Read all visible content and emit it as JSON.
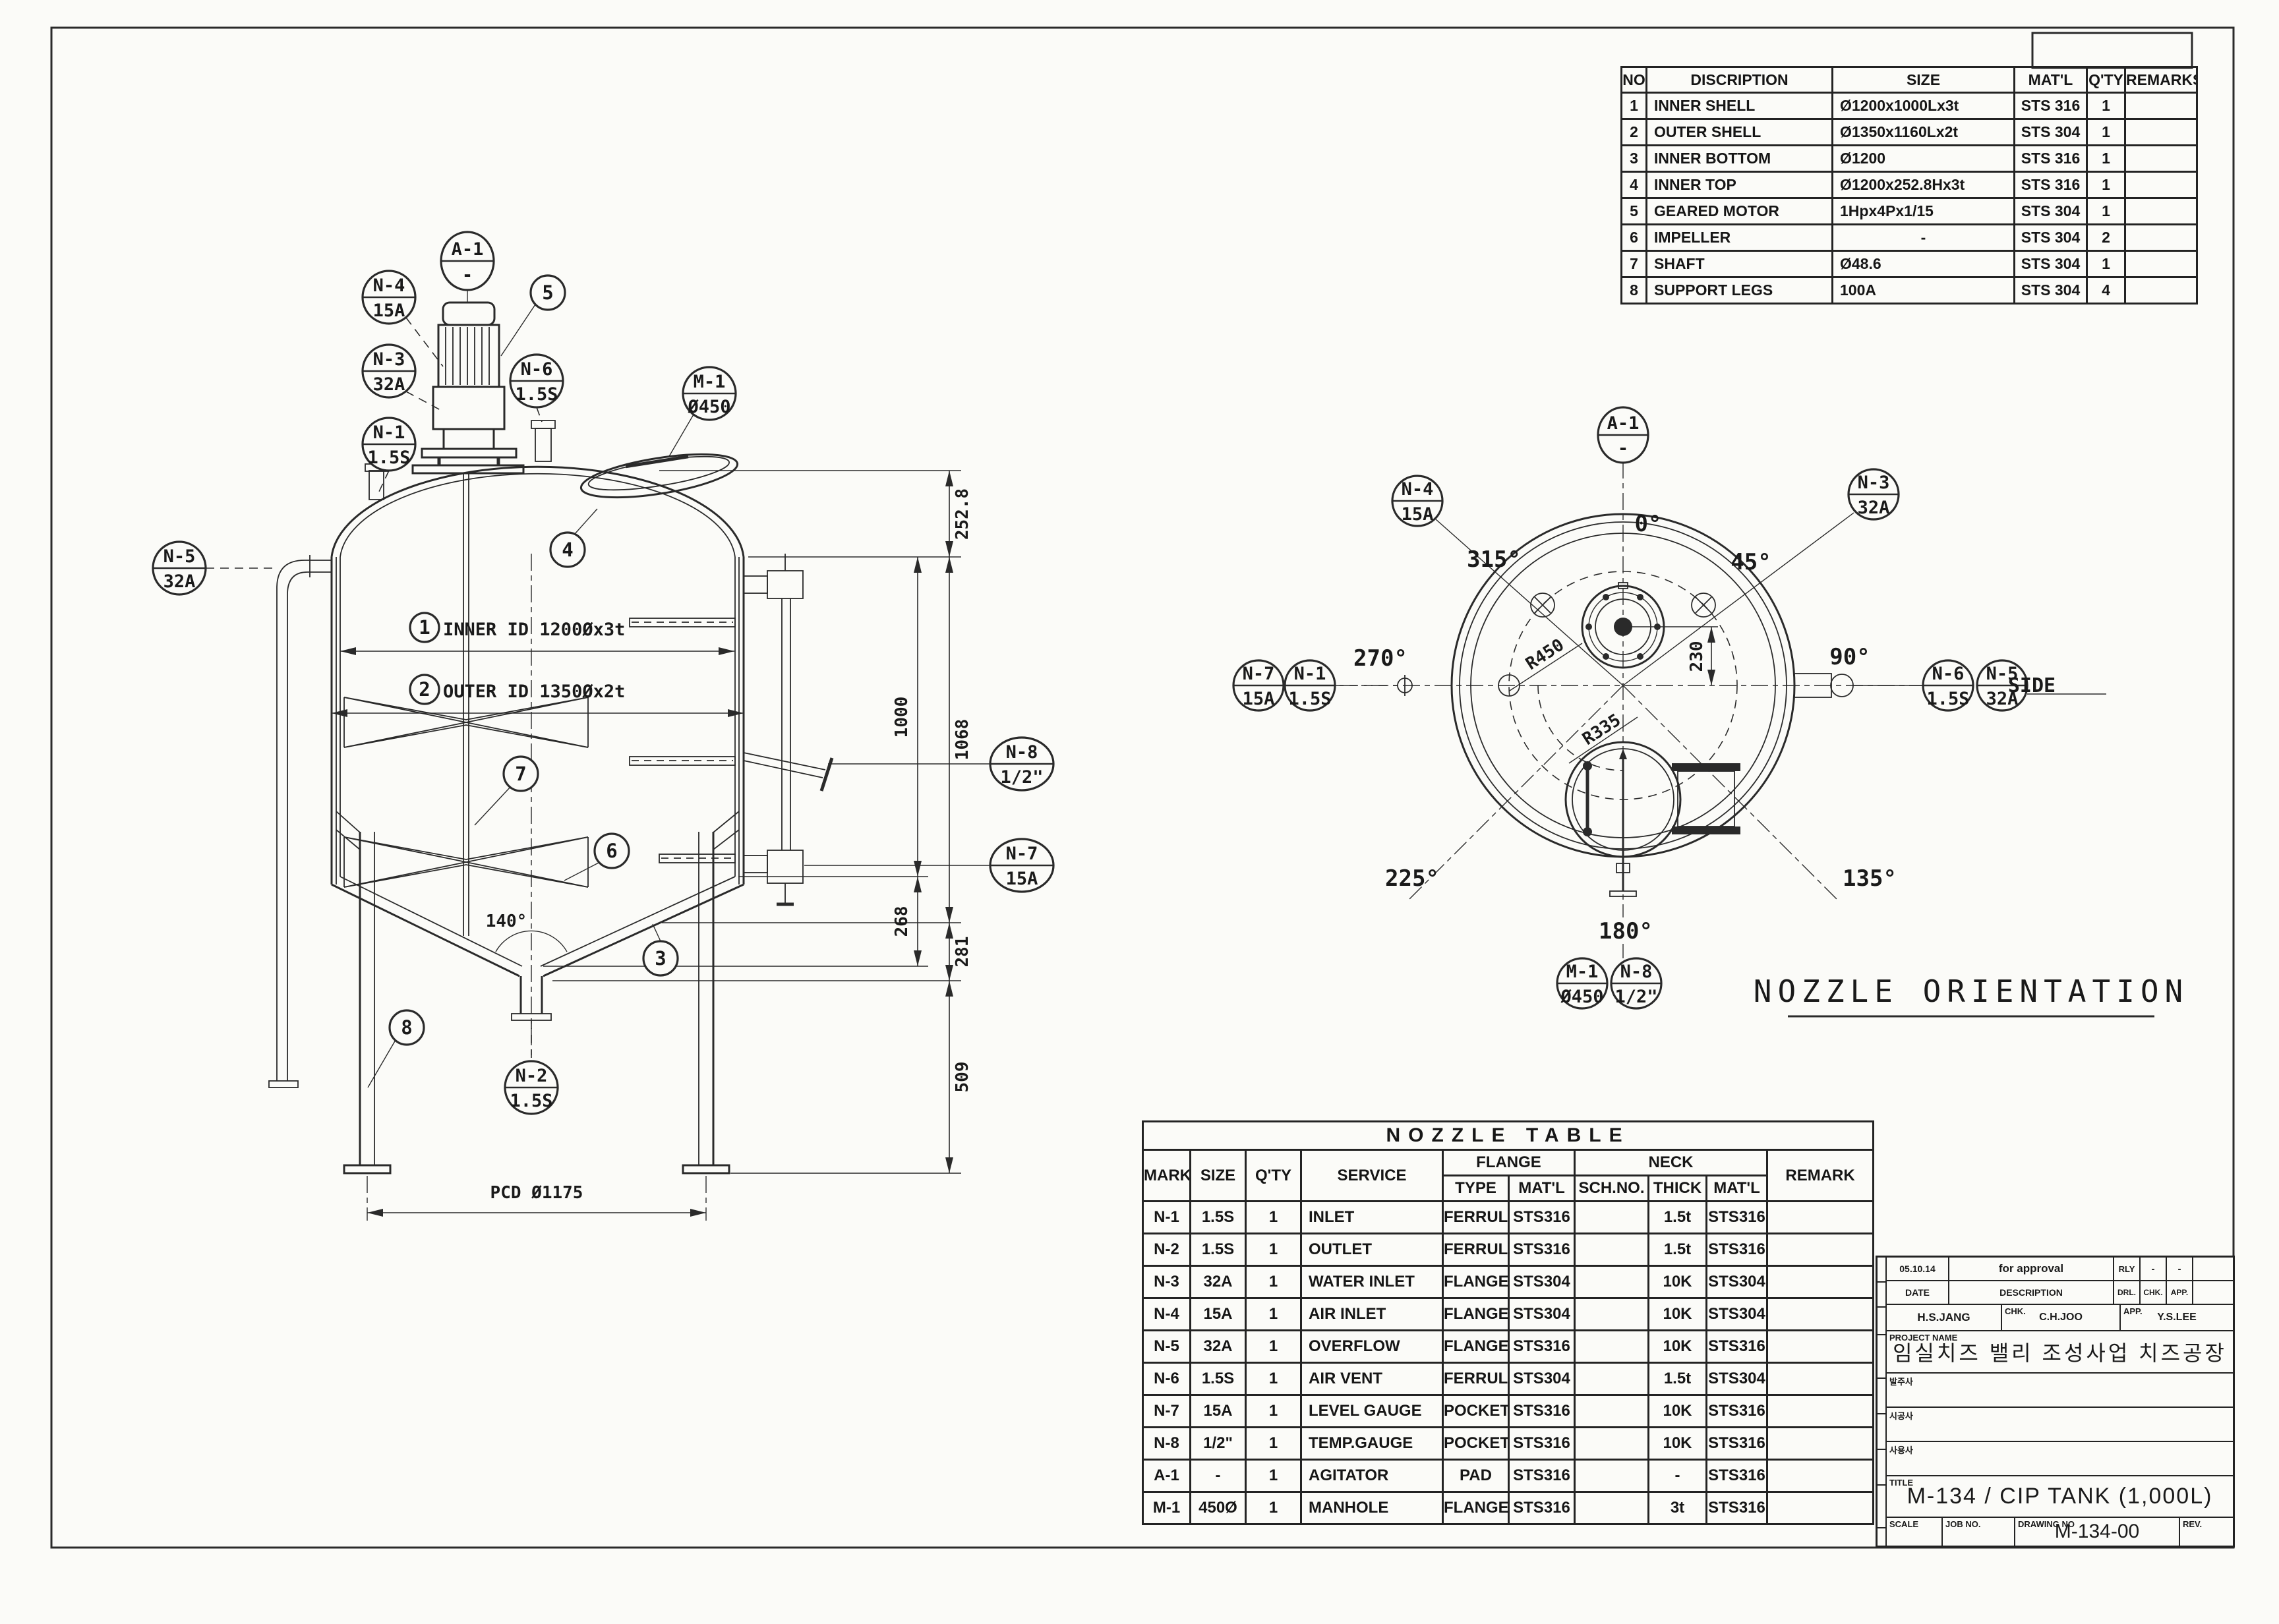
{
  "colors": {
    "ink": "#2a2a2a",
    "paper": "#fbfbf8"
  },
  "parts_table": {
    "headers": {
      "no": "NO",
      "desc": "DISCRIPTION",
      "size": "SIZE",
      "matl": "MAT'L",
      "qty": "Q'TY",
      "remarks": "REMARKS"
    },
    "rows": [
      {
        "no": "1",
        "desc": "INNER SHELL",
        "size": "Ø1200x1000Lx3t",
        "matl": "STS 316",
        "qty": "1",
        "remarks": ""
      },
      {
        "no": "2",
        "desc": "OUTER SHELL",
        "size": "Ø1350x1160Lx2t",
        "matl": "STS 304",
        "qty": "1",
        "remarks": ""
      },
      {
        "no": "3",
        "desc": "INNER BOTTOM",
        "size": "Ø1200",
        "matl": "STS 316",
        "qty": "1",
        "remarks": ""
      },
      {
        "no": "4",
        "desc": "INNER TOP",
        "size": "Ø1200x252.8Hx3t",
        "matl": "STS 316",
        "qty": "1",
        "remarks": ""
      },
      {
        "no": "5",
        "desc": "GEARED MOTOR",
        "size": "1Hpx4Px1/15",
        "matl": "STS 304",
        "qty": "1",
        "remarks": ""
      },
      {
        "no": "6",
        "desc": "IMPELLER",
        "size": "-",
        "matl": "STS 304",
        "qty": "2",
        "remarks": ""
      },
      {
        "no": "7",
        "desc": "SHAFT",
        "size": "Ø48.6",
        "matl": "STS 304",
        "qty": "1",
        "remarks": ""
      },
      {
        "no": "8",
        "desc": "SUPPORT LEGS",
        "size": "100A",
        "matl": "STS 304",
        "qty": "4",
        "remarks": ""
      }
    ]
  },
  "nozzle_table": {
    "title": "NOZZLE TABLE",
    "headers": {
      "mark": "MARK",
      "size": "SIZE",
      "qty": "Q'TY",
      "service": "SERVICE",
      "flange": "FLANGE",
      "neck": "NECK",
      "type": "TYPE",
      "flange_matl": "MAT'L",
      "sch_no": "SCH.NO.",
      "thick": "THICK",
      "neck_matl": "MAT'L",
      "remark": "REMARK"
    },
    "rows": [
      {
        "mark": "N-1",
        "size": "1.5S",
        "qty": "1",
        "service": "INLET",
        "type": "FERRULE",
        "fmatl": "STS316",
        "sch": "",
        "thick": "1.5t",
        "nmatl": "STS316",
        "remark": ""
      },
      {
        "mark": "N-2",
        "size": "1.5S",
        "qty": "1",
        "service": "OUTLET",
        "type": "FERRULE",
        "fmatl": "STS316",
        "sch": "",
        "thick": "1.5t",
        "nmatl": "STS316",
        "remark": ""
      },
      {
        "mark": "N-3",
        "size": "32A",
        "qty": "1",
        "service": "WATER INLET",
        "type": "FLANGE",
        "fmatl": "STS304",
        "sch": "",
        "thick": "10K",
        "nmatl": "STS304",
        "remark": ""
      },
      {
        "mark": "N-4",
        "size": "15A",
        "qty": "1",
        "service": "AIR INLET",
        "type": "FLANGE",
        "fmatl": "STS304",
        "sch": "",
        "thick": "10K",
        "nmatl": "STS304",
        "remark": ""
      },
      {
        "mark": "N-5",
        "size": "32A",
        "qty": "1",
        "service": "OVERFLOW",
        "type": "FLANGE",
        "fmatl": "STS316",
        "sch": "",
        "thick": "10K",
        "nmatl": "STS316",
        "remark": ""
      },
      {
        "mark": "N-6",
        "size": "1.5S",
        "qty": "1",
        "service": "AIR VENT",
        "type": "FERRULE",
        "fmatl": "STS304",
        "sch": "",
        "thick": "1.5t",
        "nmatl": "STS304",
        "remark": ""
      },
      {
        "mark": "N-7",
        "size": "15A",
        "qty": "1",
        "service": "LEVEL GAUGE",
        "type": "POCKET",
        "fmatl": "STS316",
        "sch": "",
        "thick": "10K",
        "nmatl": "STS316",
        "remark": ""
      },
      {
        "mark": "N-8",
        "size": "1/2\"",
        "qty": "1",
        "service": "TEMP.GAUGE",
        "type": "POCKET",
        "fmatl": "STS316",
        "sch": "",
        "thick": "10K",
        "nmatl": "STS316",
        "remark": ""
      },
      {
        "mark": "A-1",
        "size": "-",
        "qty": "1",
        "service": "AGITATOR",
        "type": "PAD",
        "fmatl": "STS316",
        "sch": "",
        "thick": "-",
        "nmatl": "STS316",
        "remark": ""
      },
      {
        "mark": "M-1",
        "size": "450Ø",
        "qty": "1",
        "service": "MANHOLE",
        "type": "FLANGE",
        "fmatl": "STS316",
        "sch": "",
        "thick": "3t",
        "nmatl": "STS316",
        "remark": ""
      }
    ]
  },
  "title_block": {
    "rev_date": "05.10.14",
    "rev_desc": "for approval",
    "rev_by": "RLY",
    "rev_chk": "-",
    "rev_app": "-",
    "lbl_date": "DATE",
    "lbl_desc": "DESCRIPTION",
    "lbl_drn": "DRL.",
    "lbl_chk": "CHK.",
    "lbl_app": "APP.",
    "drn_name": "H.S.JANG",
    "chk_label": "CHK.",
    "chk_name": "C.H.JOO",
    "app_label": "APP.",
    "app_name": "Y.S.LEE",
    "lbl_project": "PROJECT NAME",
    "project_name": "임실치즈 밸리 조성사업 치즈공장",
    "lbl_client": "발주사",
    "lbl_constructor": "시공사",
    "lbl_user": "사용사",
    "lbl_title": "TITLE",
    "title": "M-134 / CIP TANK (1,000L)",
    "lbl_scale": "SCALE",
    "lbl_job_no": "JOB NO.",
    "lbl_drawing_no": "DRAWING NO",
    "drawing_no": "M-134-00",
    "lbl_rev": "REV."
  },
  "elevation": {
    "balloons": {
      "a1": {
        "top": "A-1",
        "bottom": "-"
      },
      "n1": {
        "top": "N-1",
        "bottom": "1.5S"
      },
      "n2": {
        "top": "N-2",
        "bottom": "1.5S"
      },
      "n3": {
        "top": "N-3",
        "bottom": "32A"
      },
      "n4": {
        "top": "N-4",
        "bottom": "15A"
      },
      "n5": {
        "top": "N-5",
        "bottom": "32A"
      },
      "n6": {
        "top": "N-6",
        "bottom": "1.5S"
      },
      "n7": {
        "top": "N-7",
        "bottom": "15A"
      },
      "n8": {
        "top": "N-8",
        "bottom": "1/2\""
      },
      "m1": {
        "top": "M-1",
        "bottom": "Ø450"
      }
    },
    "part_refs": [
      "1",
      "2",
      "3",
      "4",
      "5",
      "6",
      "7",
      "8"
    ],
    "callout_inner": "INNER ID 1200Øx3t",
    "callout_outer": "OUTER ID 1350Øx2t",
    "dim_252": "252.8",
    "dim_1000": "1000",
    "dim_1068": "1068",
    "dim_268": "268",
    "dim_281": "281",
    "dim_509": "509",
    "dim_pcd": "PCD Ø1175",
    "cone_angle": "140°"
  },
  "orientation": {
    "title": "NOZZLE ORIENTATION",
    "angles": {
      "deg0": "0°",
      "deg45": "45°",
      "deg90": "90°",
      "deg135": "135°",
      "deg180": "180°",
      "deg225": "225°",
      "deg270": "270°",
      "deg315": "315°"
    },
    "r450": "R450",
    "r335": "R335",
    "dim_230": "230",
    "side": "SIDE",
    "balloons": {
      "a1": {
        "top": "A-1",
        "bottom": "-"
      },
      "n1": {
        "top": "N-1",
        "bottom": "1.5S"
      },
      "n3": {
        "top": "N-3",
        "bottom": "32A"
      },
      "n4": {
        "top": "N-4",
        "bottom": "15A"
      },
      "n5": {
        "top": "N-5",
        "bottom": "32A"
      },
      "n6": {
        "top": "N-6",
        "bottom": "1.5S"
      },
      "n7": {
        "top": "N-7",
        "bottom": "15A"
      },
      "n8": {
        "top": "N-8",
        "bottom": "1/2\""
      },
      "m1": {
        "top": "M-1",
        "bottom": "Ø450"
      }
    }
  }
}
